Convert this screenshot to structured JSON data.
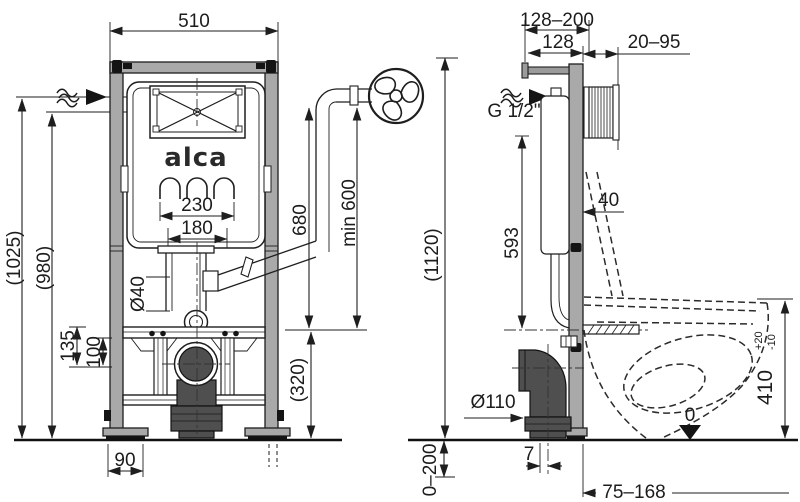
{
  "drawing": {
    "brand_logo": "alca",
    "colors": {
      "line": "#1e1e1e",
      "frame_fill": "#a9a9a9",
      "dark_fill": "#4f4f4f",
      "background": "#ffffff"
    },
    "icons": {
      "water_inlet_front": "wavy-flow-arrow-right",
      "water_inlet_side": "wavy-flow-arrow-right",
      "flush_rosette": "fan-rosette-circle",
      "floor_datum": "filled-triangle-down"
    },
    "front_view": {
      "dim_width": "510",
      "dim_height_total": "(1025)",
      "dim_height_inlet": "(980)",
      "dim_studs_outer": "230",
      "dim_studs_inner": "180",
      "dim_flush_pipe_dia": "Ø40",
      "dim_elbow_height": "680",
      "dim_min_pipe_length": "min 600",
      "dim_bar_upper": "135",
      "dim_bar_lower": "100",
      "dim_outlet_height": "(320)",
      "dim_foot_depth": "90"
    },
    "overall": {
      "dim_total_height": "(1120)"
    },
    "side_view": {
      "dim_bracket_range": "128–200",
      "dim_bracket_fixed": "128",
      "dim_wall_gap": "20–95",
      "water_thread": "G 1/2\"",
      "dim_frame_depth": "40",
      "dim_inlet_height": "593",
      "dim_waste_dia": "Ø110",
      "dim_outlet_offset": "7",
      "dim_floor_buildup": "0–200",
      "dim_bowl_depth": "75–168",
      "datum_zero": "0",
      "dim_bowl_height": "410",
      "dim_bowl_height_tol_plus": "+20",
      "dim_bowl_height_tol_minus": "-10"
    }
  }
}
